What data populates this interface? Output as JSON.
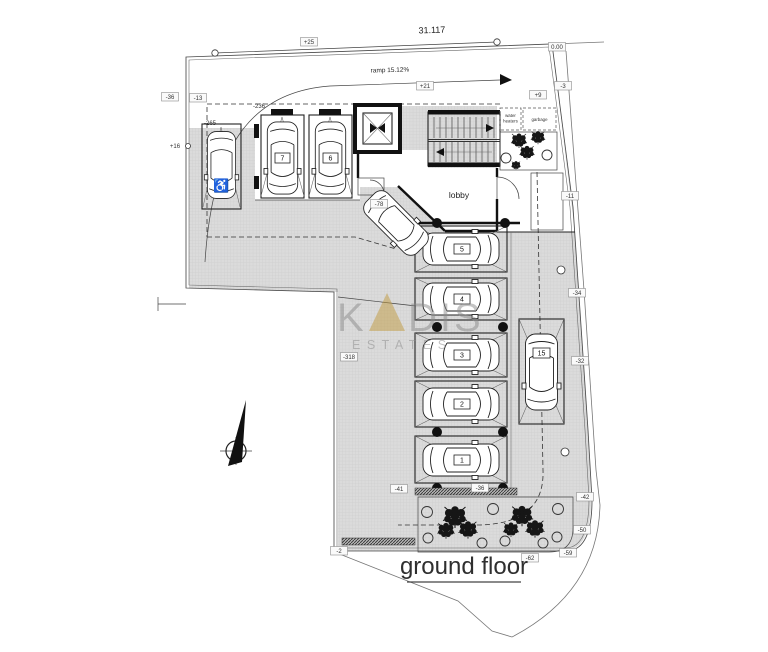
{
  "plan": {
    "title": "ground floor",
    "room_labels": {
      "lobby": "lobby",
      "water_heaters_line1": "water",
      "water_heaters_line2": "heaters",
      "garbage": "garbage"
    },
    "annotations": {
      "overall_dimension": "31.117",
      "ramp": "ramp 15.12%"
    },
    "parking_numbers": {
      "s1": "1",
      "s2": "2",
      "s3": "3",
      "s4": "4",
      "s5": "5",
      "s6": "6",
      "s7": "7",
      "s15": "15"
    },
    "icons": {
      "wheelchair": "♿"
    },
    "spot_levels": {
      "p25": "+25",
      "p21": "+21",
      "zero": "0.00",
      "m3": "-3",
      "p9": "+9",
      "m36_top": "-36",
      "m13": "-13",
      "p16": "+16",
      "m11": "-11",
      "m34": "-34",
      "m32": "-32",
      "m42": "-42",
      "m50": "-50",
      "m59": "-59",
      "m62": "-62",
      "m2": "-2",
      "m41": "-41",
      "m36_bottom": "-36",
      "m78": "-78",
      "m318": "-318",
      "m265": "-265",
      "m236": "-236"
    },
    "watermark": {
      "part_k": "K",
      "letter_a": "A",
      "part_dis": "DIS",
      "brand_bottom": "ESTATES",
      "accent_color": "#c19a3f",
      "text_color": "#8a8a8a"
    }
  }
}
